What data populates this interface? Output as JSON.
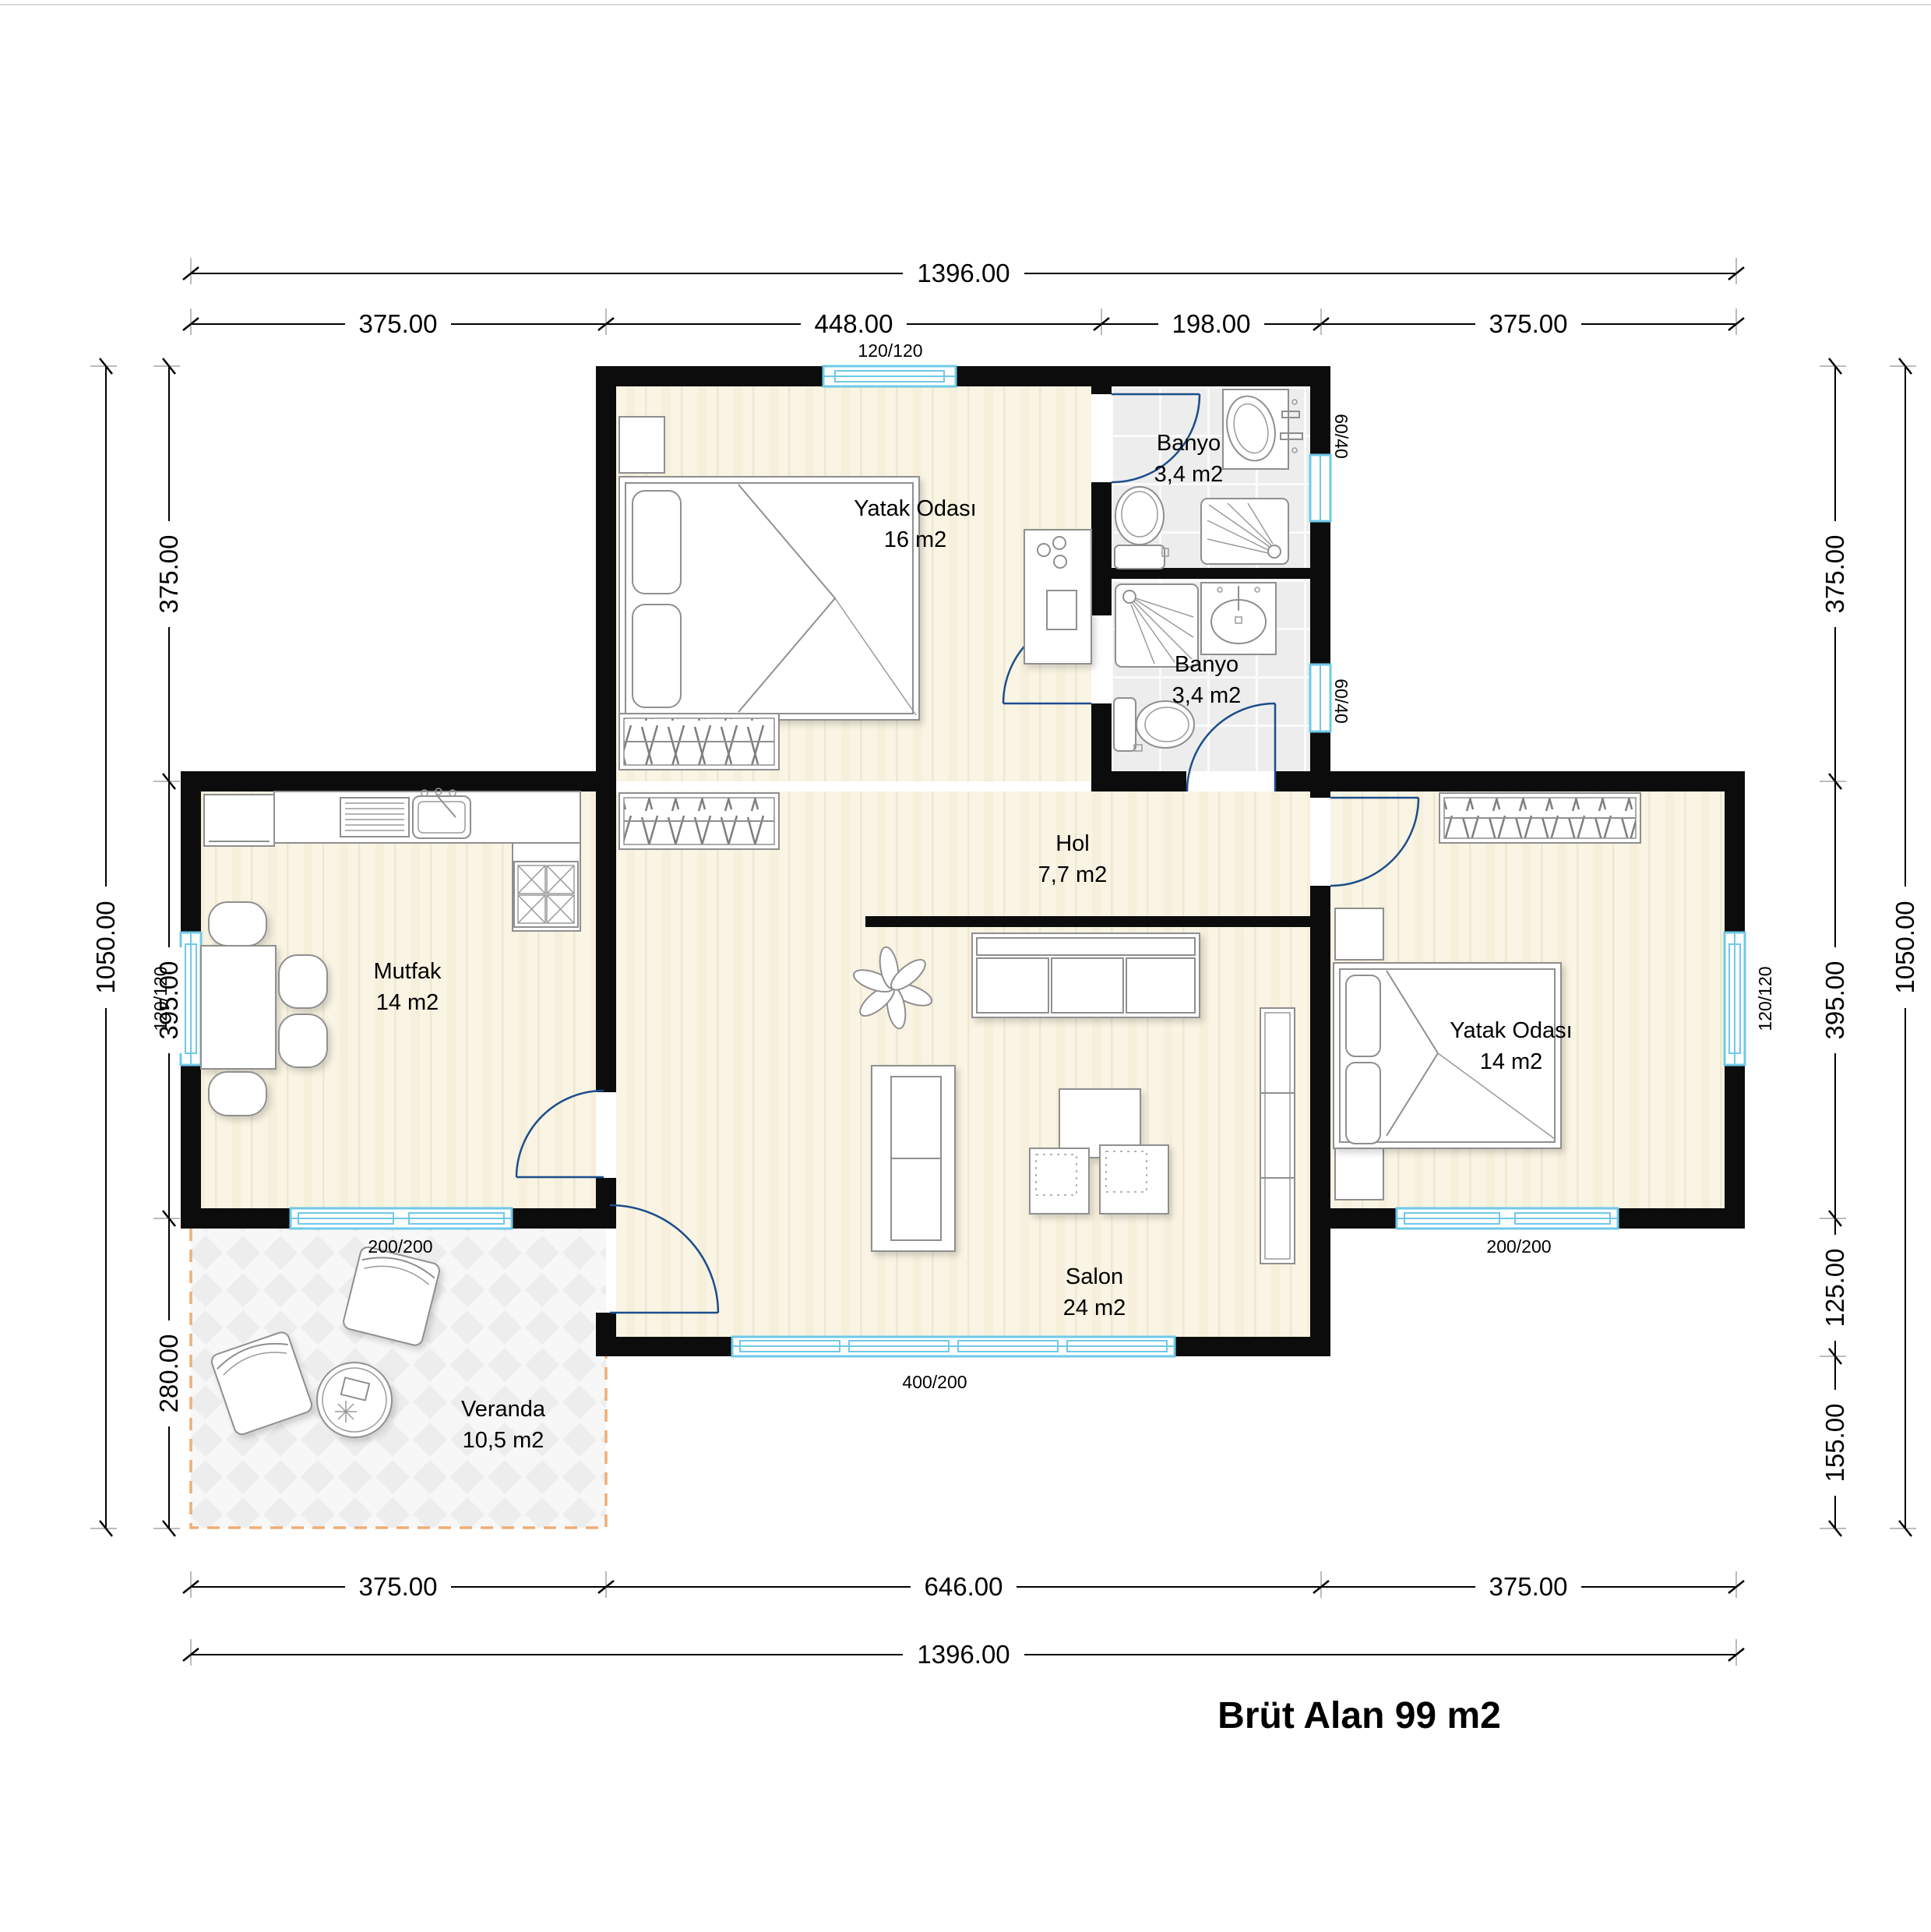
{
  "rooms": [
    {
      "id": "bedroom-1",
      "name": "Yatak Odası",
      "area": "16 m2"
    },
    {
      "id": "bath-1",
      "name": "Banyo",
      "area": "3,4 m2"
    },
    {
      "id": "bath-2",
      "name": "Banyo",
      "area": "3,4 m2"
    },
    {
      "id": "hall",
      "name": "Hol",
      "area": "7,7 m2"
    },
    {
      "id": "kitchen",
      "name": "Mutfak",
      "area": "14 m2"
    },
    {
      "id": "living-room",
      "name": "Salon",
      "area": "24 m2"
    },
    {
      "id": "bedroom-2",
      "name": "Yatak Odası",
      "area": "14 m2"
    },
    {
      "id": "veranda",
      "name": "Veranda",
      "area": "10,5 m2"
    }
  ],
  "window_tags": {
    "top_bedroom": "120/120",
    "kitchen_left": "120/120",
    "kitchen_bottom": "200/200",
    "salon_bottom": "400/200",
    "bedroom2_bottom": "200/200",
    "bedroom2_right": "120/120",
    "bath1": "60/40",
    "bath2": "60/40"
  },
  "dimensions": {
    "top_total": "1396.00",
    "top_segments": [
      "375.00",
      "448.00",
      "198.00",
      "375.00"
    ],
    "bottom_segments": [
      "375.00",
      "646.00",
      "375.00"
    ],
    "bottom_total": "1396.00",
    "left_total": "1050.00",
    "left_segments": [
      "375.00",
      "395.00",
      "280.00"
    ],
    "right_total": "1050.00",
    "right_segments": [
      "375.00",
      "395.00",
      "125.00",
      "155.00"
    ]
  },
  "footer": {
    "gross_area_label": "Brüt Alan 99 m2"
  },
  "colors": {
    "wall": "#0c0c0c",
    "window": "#6fc9e8",
    "door_arc": "#1c4e8c",
    "floor_wood": "#f9f4e3",
    "floor_tile": "#ededed",
    "veranda_dash": "#f0ad74",
    "text": "#000000"
  }
}
